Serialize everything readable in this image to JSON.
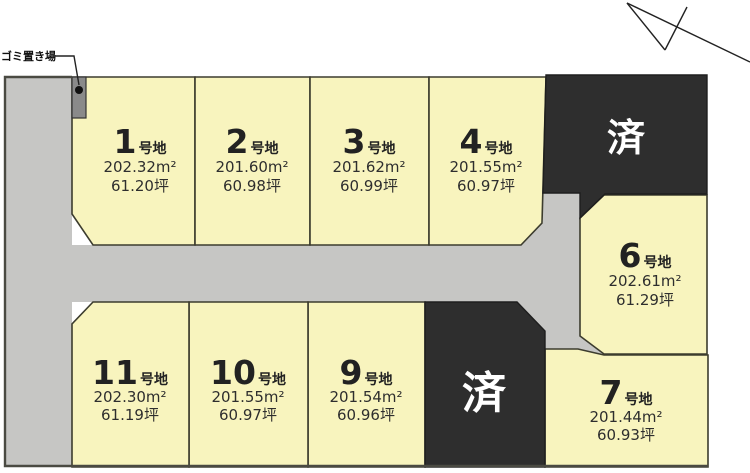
{
  "map": {
    "garbage_label": "ゴミ置き場",
    "sold_label": "済"
  },
  "lots": [
    {
      "number": "1",
      "suffix": "号地",
      "area": "202.32m²",
      "tsubo": "61.20坪"
    },
    {
      "number": "2",
      "suffix": "号地",
      "area": "201.60m²",
      "tsubo": "60.98坪"
    },
    {
      "number": "3",
      "suffix": "号地",
      "area": "201.62m²",
      "tsubo": "60.99坪"
    },
    {
      "number": "4",
      "suffix": "号地",
      "area": "201.55m²",
      "tsubo": "60.97坪"
    },
    {
      "number": "6",
      "suffix": "号地",
      "area": "202.61m²",
      "tsubo": "61.29坪"
    },
    {
      "number": "7",
      "suffix": "号地",
      "area": "201.44m²",
      "tsubo": "60.93坪"
    },
    {
      "number": "9",
      "suffix": "号地",
      "area": "201.54m²",
      "tsubo": "60.96坪"
    },
    {
      "number": "10",
      "suffix": "号地",
      "area": "201.55m²",
      "tsubo": "60.97坪"
    },
    {
      "number": "11",
      "suffix": "号地",
      "area": "202.30m²",
      "tsubo": "61.19坪"
    }
  ],
  "sold": [
    {
      "label": "済"
    },
    {
      "label": "済"
    }
  ],
  "colors": {
    "lot_fill": "#F8F4BE",
    "road_fill": "#C6C6C4",
    "sold_fill": "#2E2E2E",
    "garbage_fill": "#8A8A8A",
    "outline": "#3C3C2E",
    "sold_text": "#FFFFFF"
  }
}
